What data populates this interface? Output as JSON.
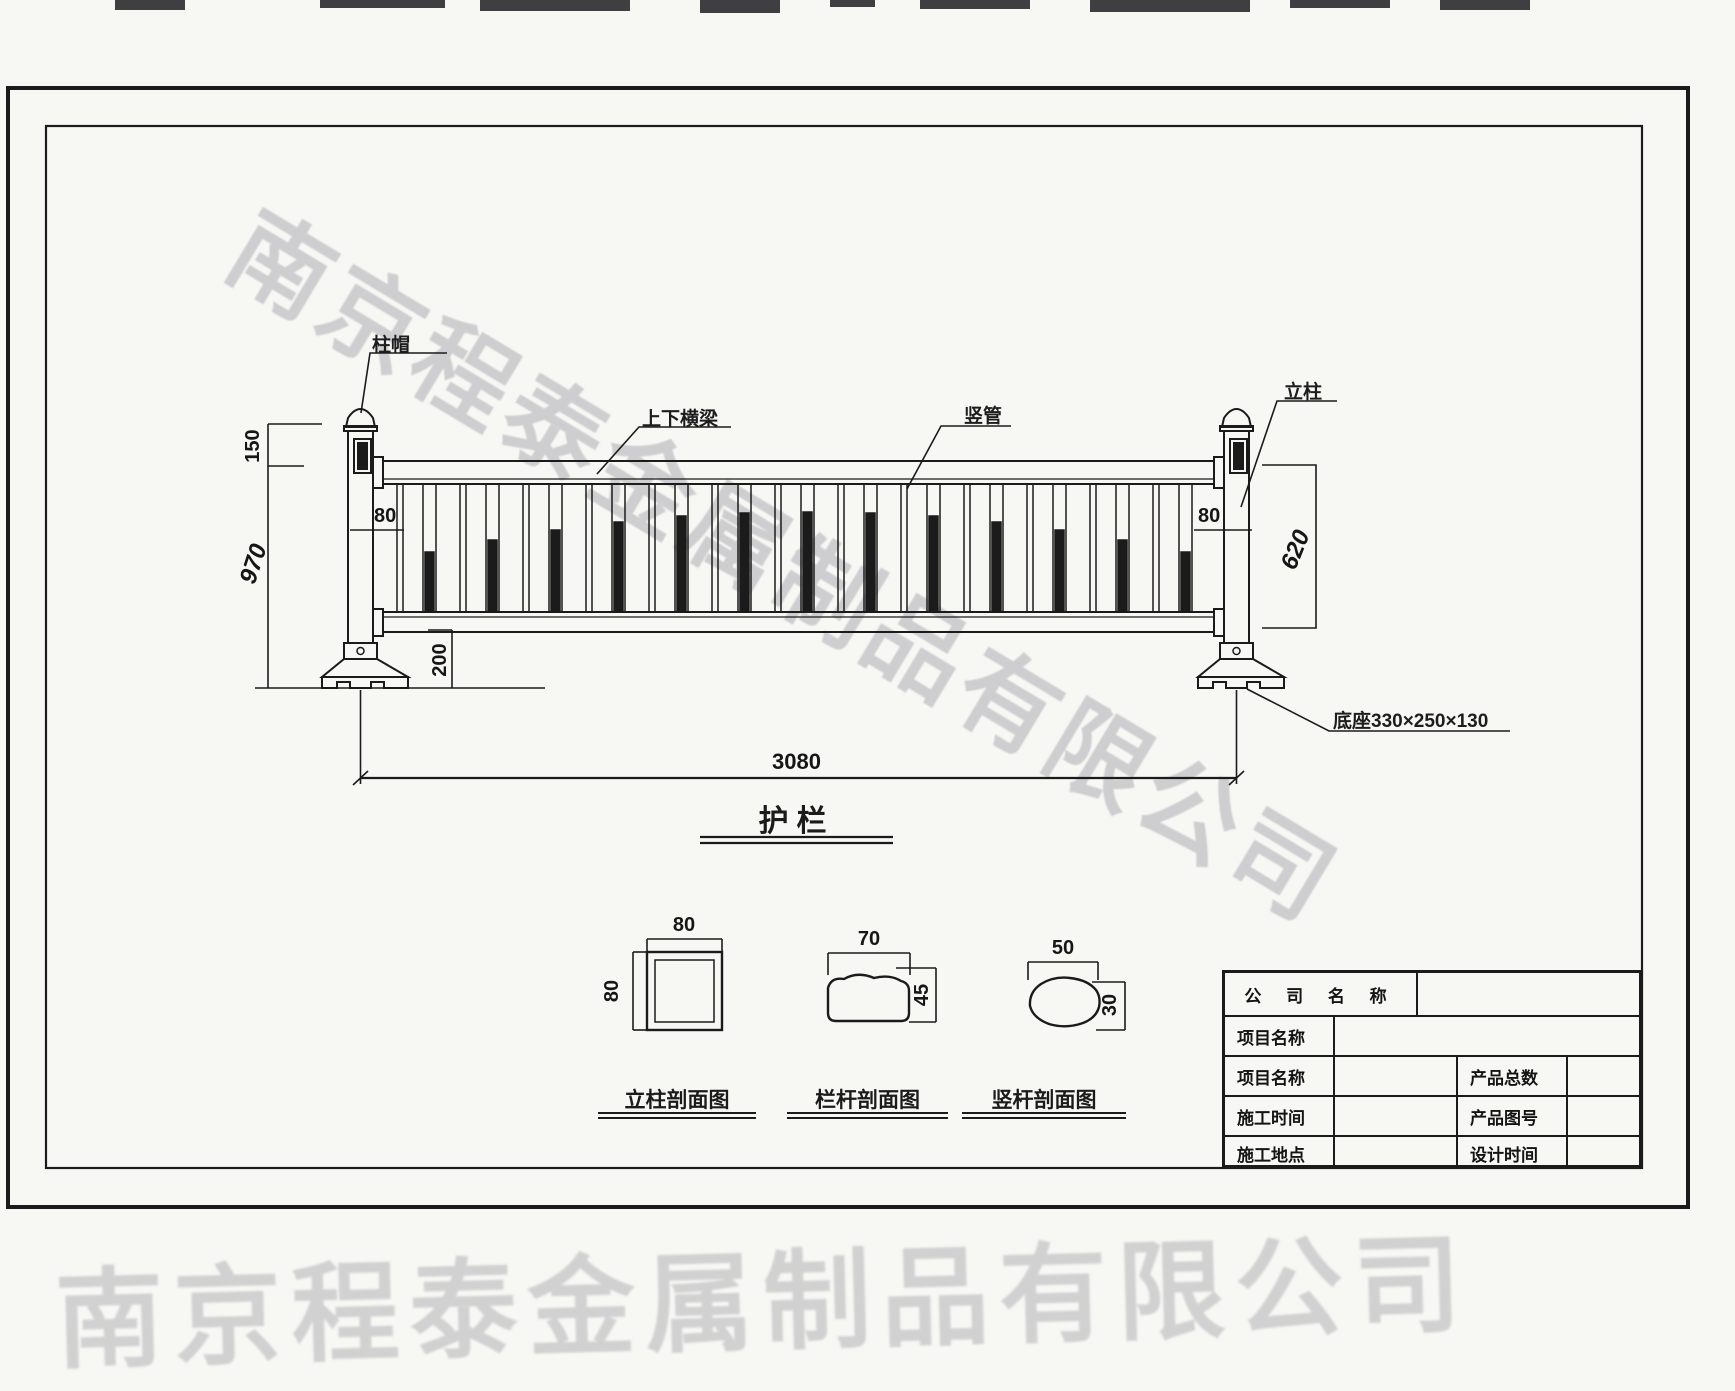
{
  "watermark": {
    "text": "南京程泰金属制品有限公司"
  },
  "title": "护栏",
  "labels": {
    "post_cap": "柱帽",
    "beams": "上下横梁",
    "vertical_tube": "竖管",
    "post": "立柱",
    "base": "底座330×250×130"
  },
  "dims": {
    "cap_150": "150",
    "height_970": "970",
    "post_80_left": "80",
    "post_80_right": "80",
    "panel_620": "620",
    "gap_200": "200",
    "length_3080": "3080"
  },
  "sections": [
    {
      "label": "立柱剖面图",
      "w": "80",
      "h": "80"
    },
    {
      "label": "栏杆剖面图",
      "w": "70",
      "h": "45"
    },
    {
      "label": "竖杆剖面图",
      "w": "50",
      "h": "30"
    }
  ],
  "title_block": {
    "company": "公 司 名 称",
    "project1": "项目名称",
    "project2": "项目名称",
    "build_time": "施工时间",
    "build_site": "施工地点",
    "product_total": "产品总数",
    "product_no": "产品图号",
    "design_time": "设计时间"
  }
}
